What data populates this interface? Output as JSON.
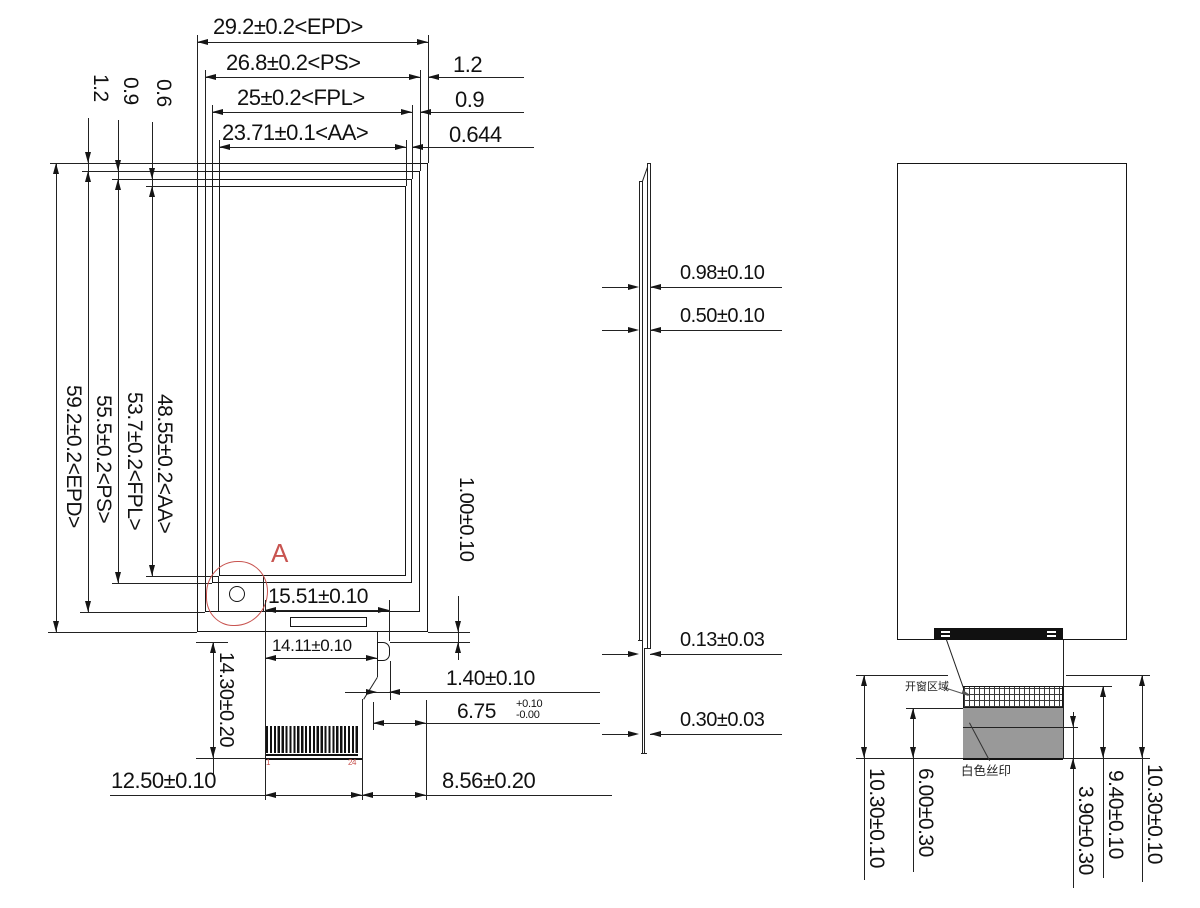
{
  "front": {
    "top_dims": [
      "29.2±0.2<EPD>",
      "26.8±0.2<PS>",
      "25±0.2<FPL>",
      "23.71±0.1<AA>"
    ],
    "top_right_gaps": [
      "1.2",
      "0.9",
      "0.644"
    ],
    "top_left_gaps": [
      "1.2",
      "0.9",
      "0.6"
    ],
    "left_dims": [
      "59.2±0.2<EPD>",
      "55.5±0.2<PS>",
      "53.7±0.2<FPL>",
      "48.55±0.2<AA>"
    ],
    "detail_label": "A",
    "slot_width": "15.51±0.10",
    "stiffener_width": "14.11±0.10",
    "tail_length": "14.30±0.20",
    "edge_gap": "1.00±0.10",
    "bump_width": "1.40±0.10",
    "offset": {
      "value": "6.75",
      "tol_plus": "+0.10",
      "tol_minus": "-0.00"
    },
    "contact_width": "12.50±0.10",
    "right_margin": "8.56±0.20",
    "pin_first": "1",
    "pin_last": "24"
  },
  "side": {
    "thickness_dims": [
      "0.98±0.10",
      "0.50±0.10",
      "0.13±0.03",
      "0.30±0.03"
    ]
  },
  "back": {
    "tail_left": "10.30±0.10",
    "silkscreen_height": "6.00±0.30",
    "silkscreen_offset": "3.90±0.30",
    "window_height": "9.40±0.10",
    "tail_right": "10.30±0.10",
    "window_label": "开窗区域",
    "silkscreen_label": "白色丝印"
  },
  "colors": {
    "line": "#1a1a1a",
    "red_accent": "#c85450",
    "silkscreen": "#999999"
  }
}
